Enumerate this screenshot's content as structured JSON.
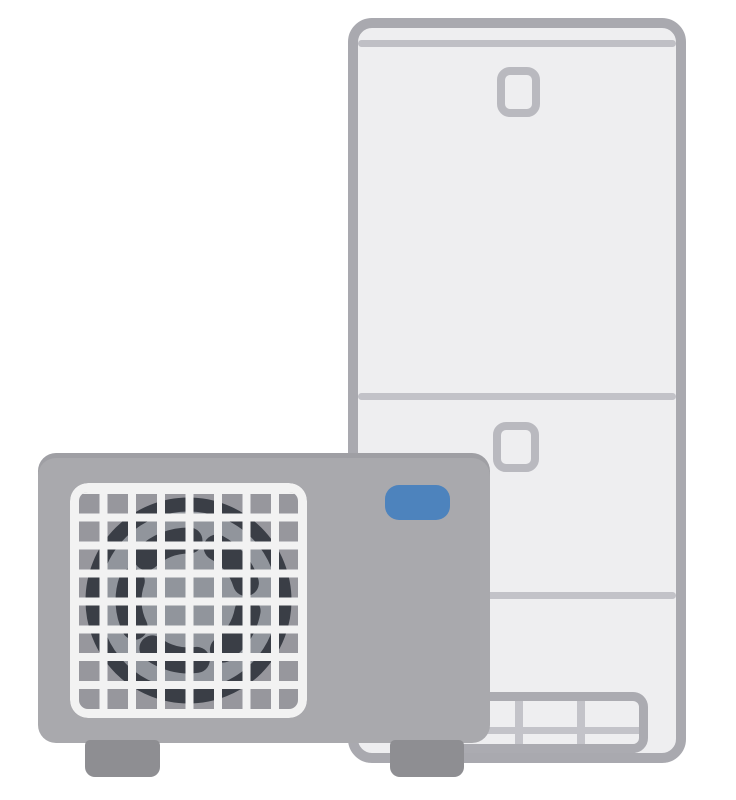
{
  "illustration": {
    "description": "Illustration of an electric heat pump water heater (EcoCute): a tall white hot water storage tank unit standing behind, and a gray heat pump outdoor unit with a square fan grille and a blue indicator label in front",
    "tank_unit_label": "hot water storage tank unit",
    "heat_pump_unit_label": "heat pump outdoor unit",
    "fan_label": "fan behind white grid grille",
    "indicator_label": "blue indicator badge"
  },
  "colors": {
    "page_bg": "#ffffff",
    "tank_fill": "#eeeef0",
    "tank_outline": "#a9a9af",
    "tank_seam_top": "#bfbfc5",
    "tank_seam": "#c2c2c8",
    "tank_detail_outline": "#b9b9bf",
    "tank_vent_frame": "#ababb1",
    "tank_vent_divider": "#c3c3c9",
    "pump_body": "#a9a9ad",
    "pump_foot": "#8e8e92",
    "grille_bg": "#97979d",
    "grille_bars": "#f2f2f2",
    "fan_ring": "#3a3e46",
    "fan_inner": "#91959c",
    "indicator_blue": "#4d83bd"
  }
}
